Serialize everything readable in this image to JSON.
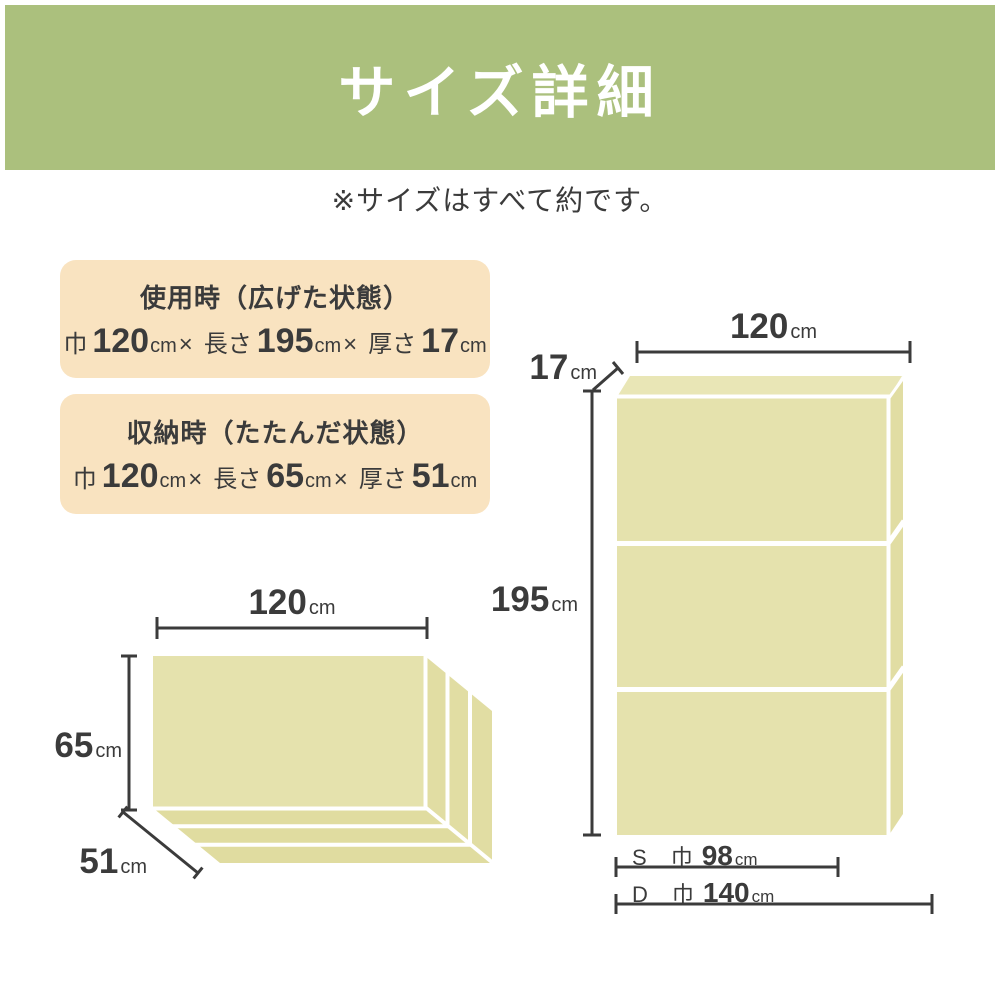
{
  "header": {
    "title": "サイズ詳細"
  },
  "note": "※サイズはすべて約です。",
  "separator": "×",
  "info_boxes": [
    {
      "title": "使用時（広げた状態）",
      "dims": [
        {
          "label": "巾",
          "value": "120",
          "unit": "cm"
        },
        {
          "label": "長さ",
          "value": "195",
          "unit": "cm"
        },
        {
          "label": "厚さ",
          "value": "17",
          "unit": "cm"
        }
      ]
    },
    {
      "title": "収納時（たたんだ状態）",
      "dims": [
        {
          "label": "巾",
          "value": "120",
          "unit": "cm"
        },
        {
          "label": "長さ",
          "value": "65",
          "unit": "cm"
        },
        {
          "label": "厚さ",
          "value": "51",
          "unit": "cm"
        }
      ]
    }
  ],
  "diagrams": {
    "unfolded": {
      "width": {
        "value": "120",
        "unit": "cm"
      },
      "thickness": {
        "value": "17",
        "unit": "cm"
      },
      "length": {
        "value": "195",
        "unit": "cm"
      },
      "size_rows": [
        {
          "size": "S",
          "label": "巾",
          "value": "98",
          "unit": "cm"
        },
        {
          "size": "D",
          "label": "巾",
          "value": "140",
          "unit": "cm"
        }
      ]
    },
    "folded": {
      "width": {
        "value": "120",
        "unit": "cm"
      },
      "height": {
        "value": "65",
        "unit": "cm"
      },
      "depth": {
        "value": "51",
        "unit": "cm"
      }
    }
  },
  "colors": {
    "header_bg": "#abc07d",
    "header_text": "#ffffff",
    "info_box_bg": "#f9e3c0",
    "mattress_front": "#e5e2ad",
    "mattress_side": "#e1dda3",
    "mattress_top": "#e9e6b6",
    "mattress_bottom": "#e0dca0",
    "line": "#3b3b3b",
    "text": "#3b3b3b"
  }
}
